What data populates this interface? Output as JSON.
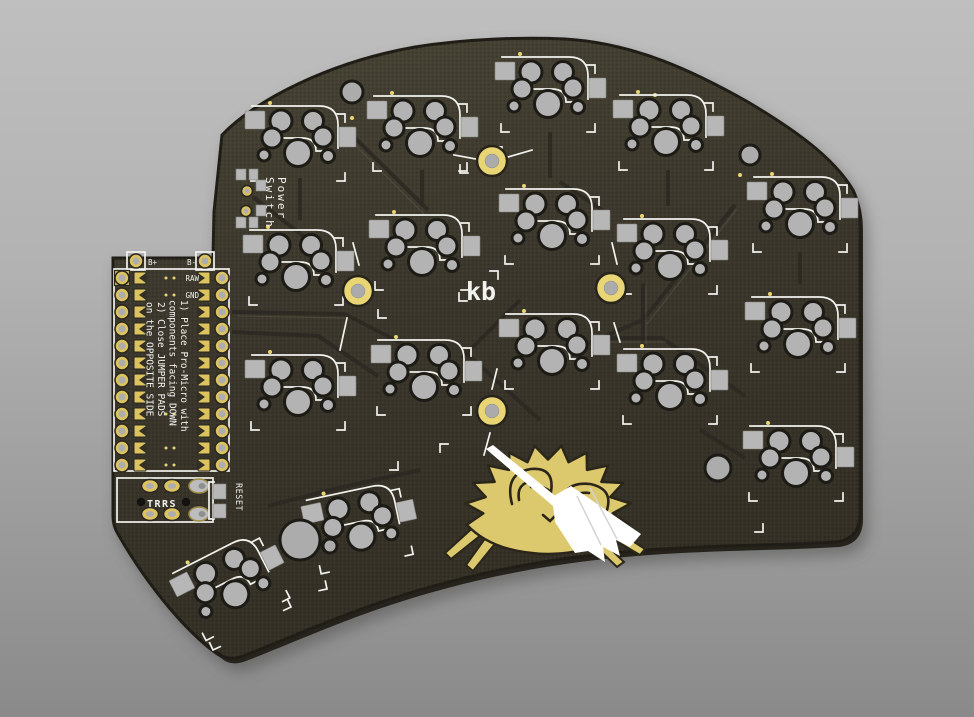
{
  "labels": {
    "note1_line1": "1) Place Pro-Micro with",
    "note1_line2": "components facing DOWN",
    "note2_line1": "2) Close JUMPER PADS",
    "note2_line2": "on the OPPOSITE SIDE",
    "battery_plus": "B+",
    "battery_minus": "B-",
    "pin_raw": "RAW",
    "pin_gnd": "GND",
    "power_line1": "Power",
    "power_line2": "Switch",
    "trrs": "TRRS",
    "reset": "RESET",
    "logo": "kb"
  },
  "colors": {
    "background_top": "#bfbfbf",
    "background_bottom": "#8a8a8a",
    "pcb": "#3b372c",
    "pcb_light": "#474334",
    "pcb_dark": "#332f25",
    "pcb_edge": "#201d16",
    "pcb_side": "#26231c",
    "pad_silver": "#b4b4b4",
    "hole_ring": "#1d1b15",
    "gold": "#dcc35f",
    "gold_bright": "#e9d573",
    "silk": "#f2f2ee",
    "trace_dark": "#2b2822",
    "trace_light": "#5a5545",
    "crab_gold": "#dcc96d",
    "crab_line": "#2b2619",
    "broom_white": "#ffffff",
    "hole_black": "#141210"
  },
  "pcb_layout": {
    "outline": "M 113,258 L 213,258 L 214,212 L 222,135 C 255,100 330,62 415,47 C 465,39 520,37 565,39 C 635,43 695,72 748,102 C 790,127 833,156 853,190 Q 860,204 860,226 L 860,514 Q 860,539 836,542 C 770,546 690,545 612,553 C 540,560 470,574 400,596 C 345,613 287,639 243,656 Q 228,662 218,653 C 192,638 150,590 118,534 Q 113,526 113,516 Z",
    "key_clusters": [
      {
        "x": 298,
        "y": 137,
        "rot": 0
      },
      {
        "x": 296,
        "y": 261,
        "rot": 0
      },
      {
        "x": 298,
        "y": 386,
        "rot": 0
      },
      {
        "x": 420,
        "y": 127,
        "rot": 0
      },
      {
        "x": 422,
        "y": 246,
        "rot": 0
      },
      {
        "x": 424,
        "y": 371,
        "rot": 0
      },
      {
        "x": 548,
        "y": 88,
        "rot": 0
      },
      {
        "x": 552,
        "y": 220,
        "rot": 0
      },
      {
        "x": 552,
        "y": 345,
        "rot": 0
      },
      {
        "x": 666,
        "y": 126,
        "rot": 0
      },
      {
        "x": 670,
        "y": 250,
        "rot": 0
      },
      {
        "x": 670,
        "y": 380,
        "rot": 0
      },
      {
        "x": 800,
        "y": 208,
        "rot": 0
      },
      {
        "x": 798,
        "y": 328,
        "rot": 0
      },
      {
        "x": 796,
        "y": 457,
        "rot": 0
      },
      {
        "x": 358,
        "y": 521,
        "rot": -12
      },
      {
        "x": 228,
        "y": 580,
        "rot": -27
      }
    ],
    "mounting_holes": [
      {
        "x": 492,
        "y": 161,
        "lines": [
          [
            -38,
            -6,
            -16,
            -2
          ],
          [
            16,
            -4,
            40,
            -11
          ]
        ]
      },
      {
        "x": 358,
        "y": 291,
        "lines": [
          [
            -5,
            -48,
            1,
            -26
          ],
          [
            -11,
            27,
            -18,
            59
          ]
        ]
      },
      {
        "x": 611,
        "y": 288,
        "lines": [
          [
            1,
            -45,
            6,
            -24
          ],
          [
            3,
            35,
            9,
            54
          ]
        ]
      },
      {
        "x": 492,
        "y": 411,
        "lines": [
          [
            5,
            -42,
            0,
            -22
          ],
          [
            -2,
            22,
            -8,
            44
          ]
        ]
      }
    ],
    "spare_holes": [
      {
        "x": 352,
        "y": 92,
        "r": 11
      },
      {
        "x": 750,
        "y": 155,
        "r": 10
      },
      {
        "x": 718,
        "y": 468,
        "r": 13
      },
      {
        "x": 300,
        "y": 540,
        "r": 20
      },
      {
        "x": 330,
        "y": 546,
        "r": 7
      }
    ],
    "traces_dark": [
      "M352,135 L428,210",
      "M253,197 L330,257",
      "M735,205 L643,320 L568,352",
      "M600,338 L662,338 L745,396",
      "M232,312 L345,314 L418,352",
      "M232,332 L318,336 L378,376",
      "M465,352 L540,420",
      "M520,300 L462,358",
      "M268,506 L330,490 L420,470",
      "M560,182 L608,214",
      "M643,283 L643,347",
      "M700,430 L745,458",
      "M300,178 L300,220",
      "M422,170 L422,206",
      "M550,132 L550,178",
      "M668,170 L668,206",
      "M800,252 L800,284"
    ],
    "traces_light": [
      "M350,140 L424,214",
      "M237,316 L345,318",
      "M646,286 L646,344",
      "M737,209 L647,324",
      "M604,342 L666,342"
    ],
    "brackets": [
      {
        "x": 460,
        "y": 173,
        "o": "bl",
        "rot": 0
      },
      {
        "x": 502,
        "y": 147,
        "o": "tr",
        "rot": 0
      },
      {
        "x": 378,
        "y": 318,
        "o": "bl",
        "rot": 0
      },
      {
        "x": 617,
        "y": 524,
        "o": "bl",
        "rot": 0
      },
      {
        "x": 763,
        "y": 532,
        "o": "br",
        "rot": 0
      },
      {
        "x": 213,
        "y": 650,
        "o": "bl",
        "rot": -25
      },
      {
        "x": 291,
        "y": 607,
        "o": "br",
        "rot": -25
      },
      {
        "x": 327,
        "y": 589,
        "o": "br",
        "rot": -12
      },
      {
        "x": 398,
        "y": 470,
        "o": "br",
        "rot": 0
      },
      {
        "x": 440,
        "y": 444,
        "o": "tl",
        "rot": 0
      },
      {
        "x": 498,
        "y": 271,
        "o": "tr",
        "rot": 0
      },
      {
        "x": 459,
        "y": 301,
        "o": "bl",
        "rot": 0
      },
      {
        "x": 510,
        "y": 480,
        "o": "bl",
        "rot": 0
      }
    ],
    "vias": [
      [
        655,
        95
      ],
      [
        352,
        118
      ],
      [
        740,
        175
      ]
    ],
    "promicro": {
      "outline": [
        114,
        269,
        115,
        202
      ],
      "rows": 12,
      "y0": 278,
      "dy": 17,
      "th_left_x": 122,
      "th_right_x": 222,
      "jp_left_x": 140,
      "jp_right_x": 204,
      "dot_rows": [
        0,
        1,
        8,
        10,
        11
      ],
      "dots_x": [
        166,
        174
      ],
      "bat": {
        "left_cx": 136,
        "right_cx": 205,
        "cy": 261,
        "box": 18
      }
    },
    "trrs": {
      "outline": [
        117,
        478,
        96,
        44
      ],
      "cols": [
        150,
        172,
        199
      ],
      "rows": [
        486,
        514
      ],
      "holes": [
        [
          141,
          502
        ],
        [
          186,
          502
        ]
      ]
    },
    "reset": {
      "pads": [
        [
          213,
          484,
          13,
          15
        ],
        [
          213,
          504,
          13,
          14
        ]
      ],
      "bracket": "M214,482 L209,482 L209,519 L214,519"
    },
    "power": {
      "pads": [
        [
          236,
          169,
          10,
          11
        ],
        [
          249,
          169,
          9,
          11
        ],
        [
          256,
          180,
          10,
          11
        ],
        [
          256,
          205,
          10,
          11
        ],
        [
          236,
          217,
          10,
          11
        ],
        [
          249,
          217,
          9,
          11
        ]
      ],
      "holes": [
        [
          247,
          191
        ],
        [
          246,
          211
        ]
      ]
    },
    "crab": {
      "cx": 548,
      "cy": 511,
      "rx": 83,
      "ry": 66,
      "spikes": 11,
      "inner": 0.78,
      "legs": [
        "M486,531 L451,559 L445,553 L478,523 Z",
        "M498,540 L473,571 L466,565 L489,533 Z",
        "M609,526 L645,549 L640,555 L603,533 Z",
        "M596,535 L624,562 L617,567 L590,541 Z"
      ],
      "details": [
        "M512,504 Q504,473 531,469 Q555,467 551,492 Q541,484 531,487",
        "M519,500 Q516,483 533,481",
        "M560,510 Q561,481 590,484 Q615,489 606,513 Q596,502 588,506",
        "M572,504 Q574,491 589,493",
        "M543,515 L550,521 L557,514"
      ],
      "broom_stick": "M486,449 L493,445 L559,499 L553,506 Z",
      "broom_head": "M552,497 L571,486 L641,534 L630,547 L616,540 L620,556 L603,547 L605,562 L588,551 L575,553 L555,522 Z",
      "broom_lines": [
        "M577,496 L601,545",
        "M590,488 L617,539"
      ]
    }
  }
}
